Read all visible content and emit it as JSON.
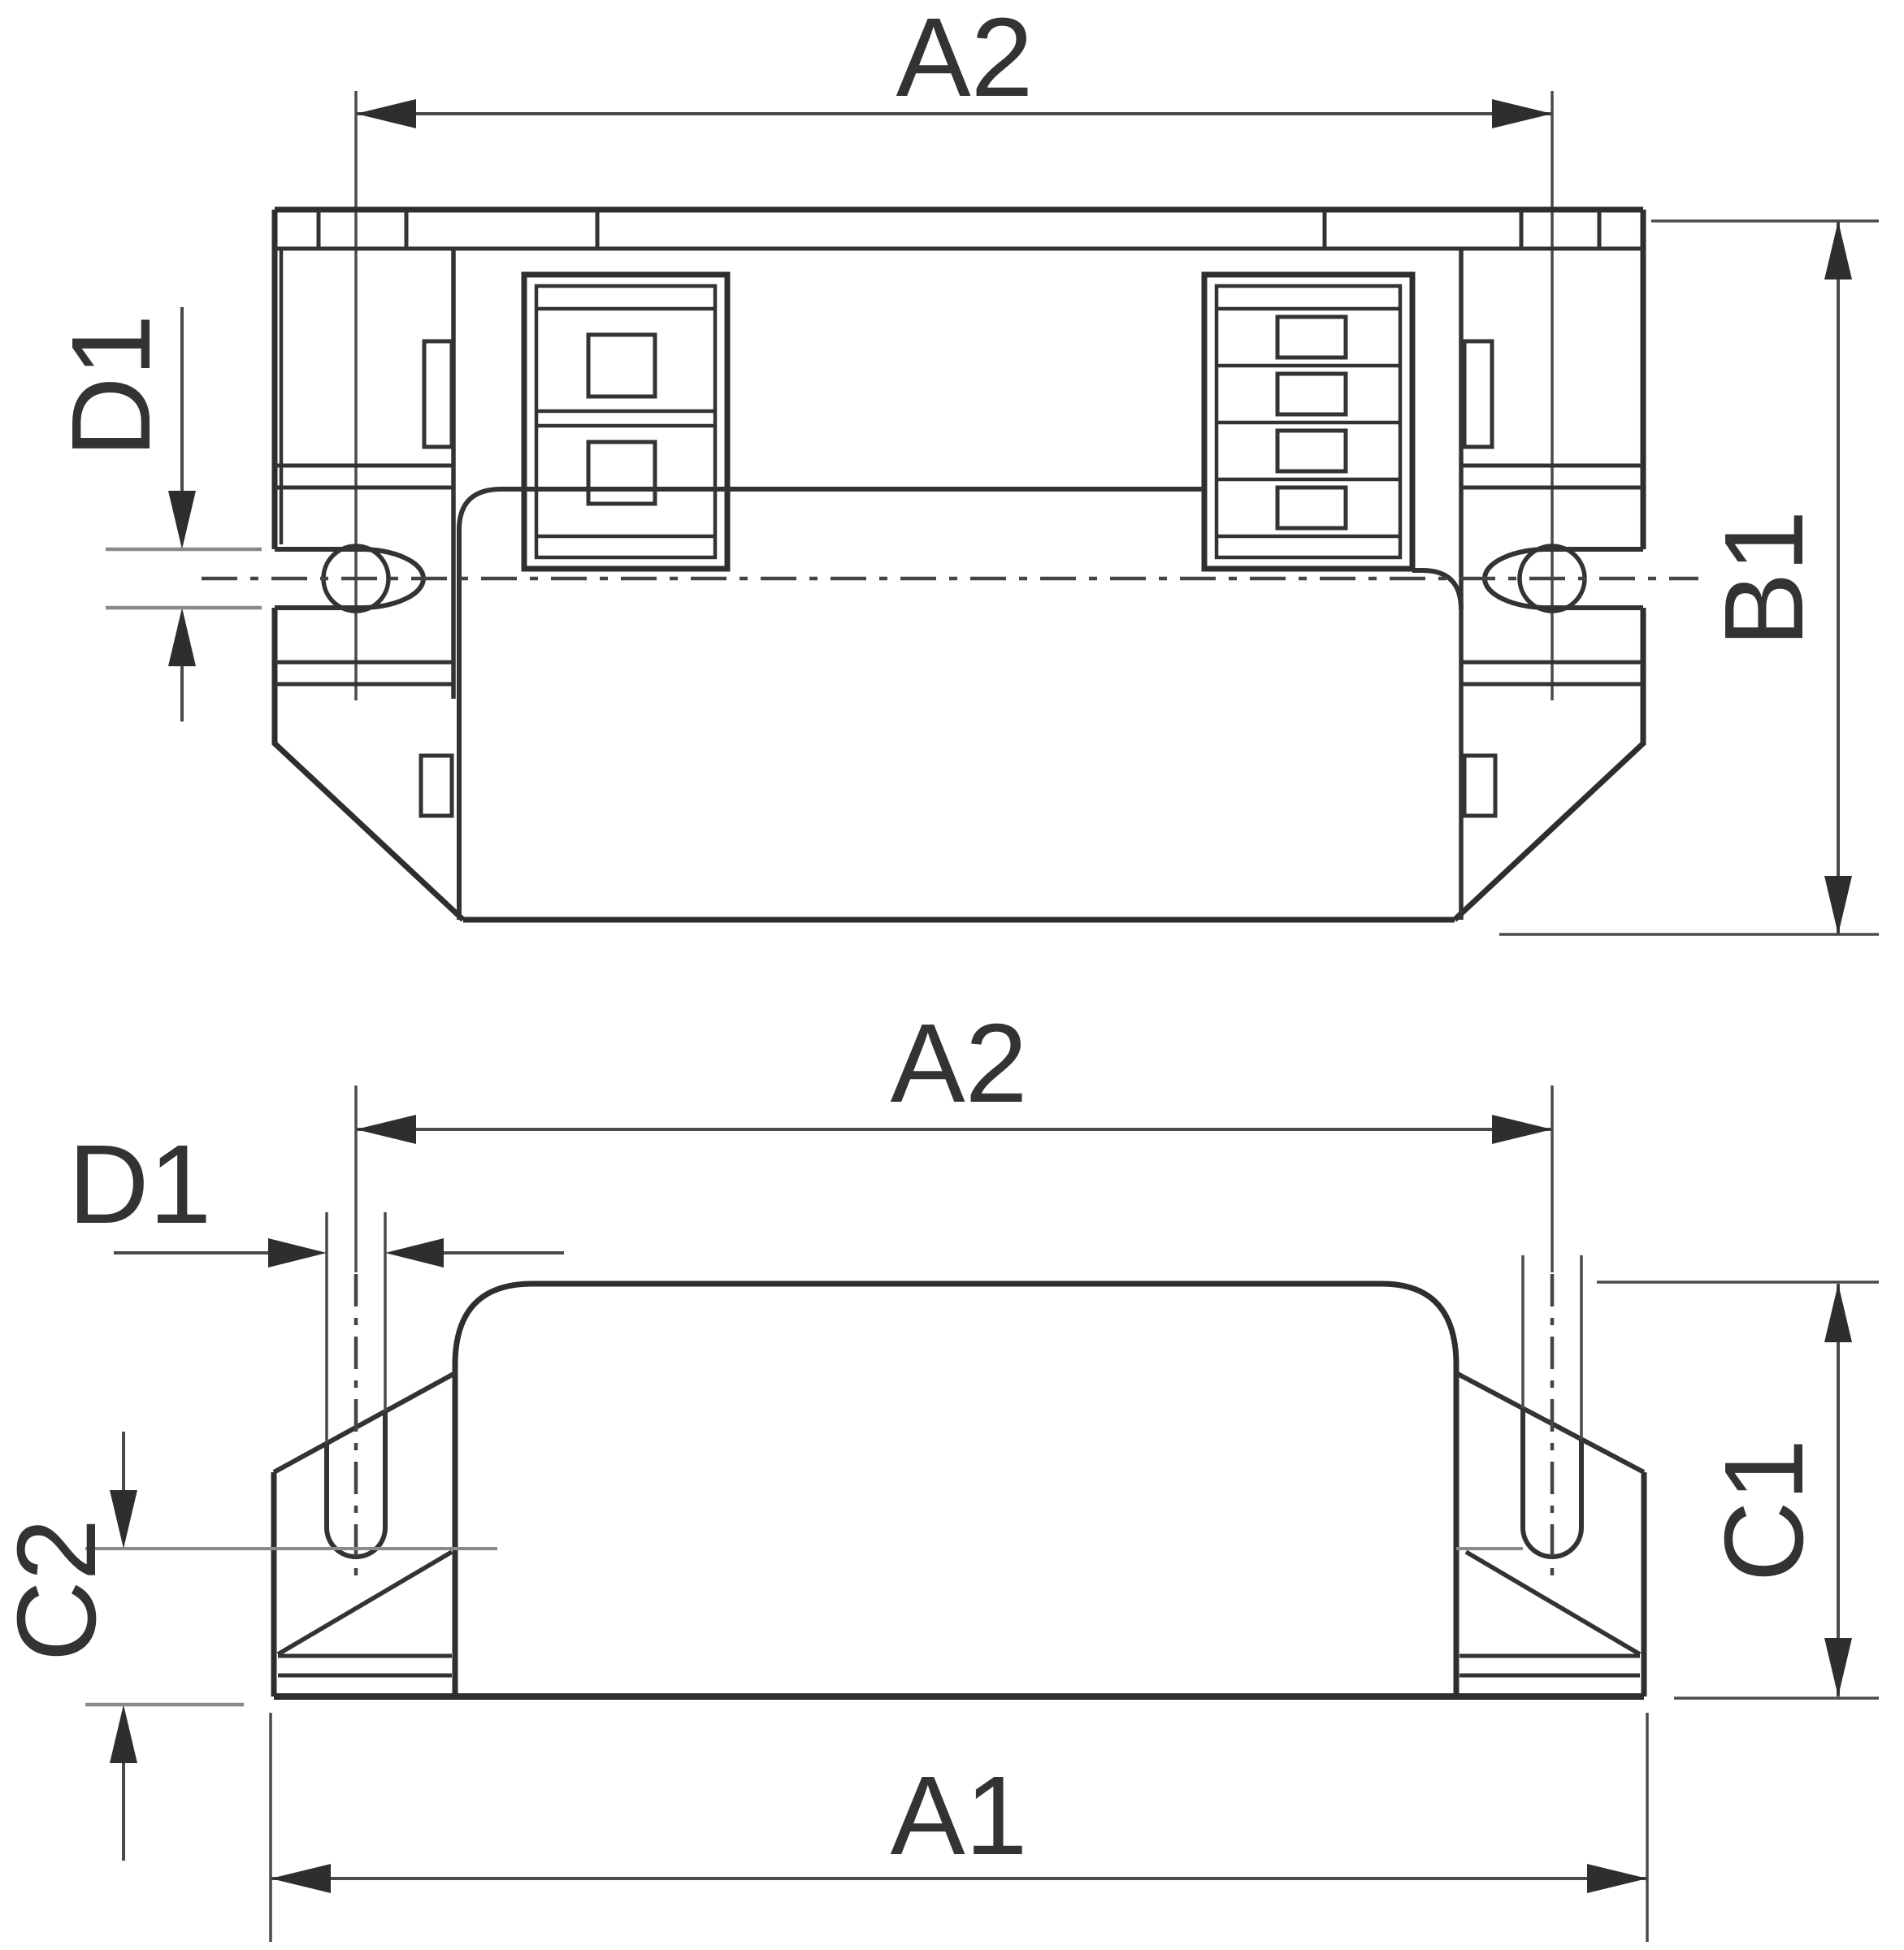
{
  "figure": {
    "kind": "engineering dimension drawing, two orthographic views of an electronic ballast housing"
  },
  "colors": {
    "background": "#ffffff",
    "outline": "#333333",
    "dimension_line": "#4a4a4a",
    "dimension_tick": "#8a8a8a",
    "label_text": "#333333"
  },
  "labels": {
    "top_view": {
      "a2": "A2",
      "d1": "D1",
      "b1": "B1"
    },
    "side_view": {
      "a2": "A2",
      "d1": "D1",
      "c2": "C2",
      "c1": "C1",
      "a1": "A1"
    }
  }
}
